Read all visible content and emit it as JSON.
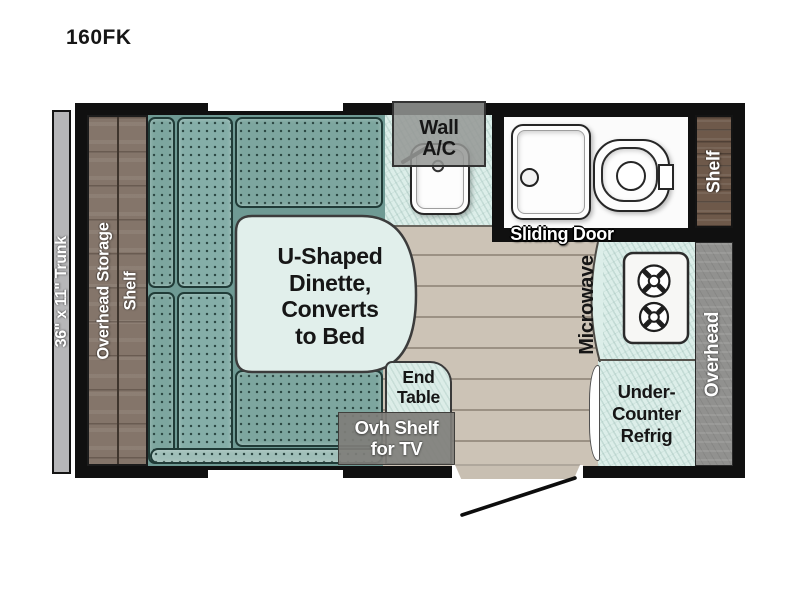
{
  "title": "160FK",
  "exterior": {
    "trunk_label": "36\" x 11\" Trunk"
  },
  "storage": {
    "left_line1": "Overhead Storage",
    "left_line2": "Shelf",
    "right_shelf_label": "Shelf",
    "overhead_label": "Overhead",
    "ovh_tv_line1": "Ovh Shelf",
    "ovh_tv_line2": "for TV"
  },
  "dinette": {
    "line1": "U-Shaped",
    "line2": "Dinette,",
    "line3": "Converts",
    "line4": "to Bed",
    "end_table_line1": "End",
    "end_table_line2": "Table"
  },
  "kitchen": {
    "ac_line1": "Wall",
    "ac_line2": "A/C",
    "microwave_label": "Microwave",
    "refrig_line1": "Under-",
    "refrig_line2": "Counter",
    "refrig_line3": "Refrig"
  },
  "bathroom": {
    "sliding_door_label": "Sliding Door"
  },
  "icons": [
    "faucet-icon",
    "sink-basin",
    "shower-pan",
    "shower-drain-icon",
    "toilet-icon",
    "stove-burner-icon",
    "door-swing-icon",
    "window",
    "entry-step"
  ],
  "colors": {
    "cushion_teal": "#85aea8",
    "cushion_dark": "#7da69f",
    "cushion_light": "#9fbeb8",
    "table_mint": "#e1efeb",
    "counter_mint": "#dceee9",
    "floor_tan": "#ccc3b6",
    "wood_brown": "#84756a",
    "shelf_wood": "#6e594a",
    "overhead_gray": "#91918f",
    "trunk_gray": "#b6b6b8",
    "wall_black": "#101010"
  }
}
